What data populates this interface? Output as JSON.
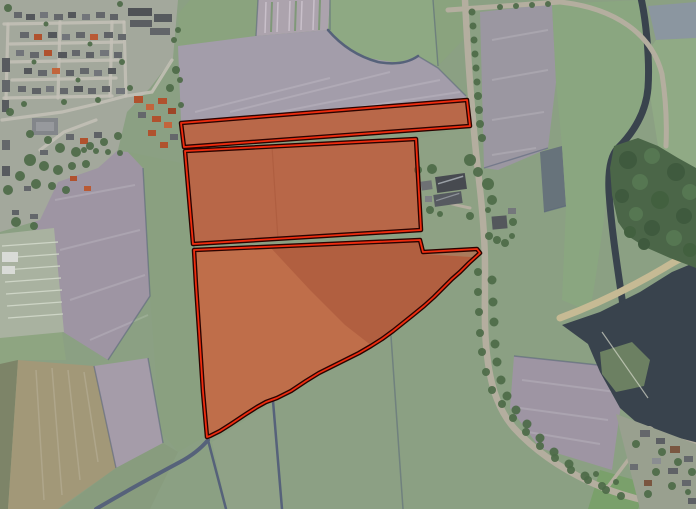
{
  "map": {
    "view_type": "aerial-imagery-with-parcel-overlay",
    "overlay": {
      "fill_color": "#e03414",
      "fill_opacity": "0.36",
      "casing_color": "#2a0300",
      "casing_width": "4.5",
      "stroke_color": "#ef2c0e",
      "stroke_width": "1.8",
      "parcels": [
        {
          "id": "parcel-north-strip",
          "points": "181,123 467,100 470,126 184,147"
        },
        {
          "id": "parcel-middle",
          "points": "185,151 416,139 421,230 193,244"
        },
        {
          "id": "parcel-south",
          "points": "194,250 420,240 423,252 477,249 480,253 469,263 460,272 452,279 444,287 434,297 424,306 413,315 403,323 393,331 382,339 371,346 359,353 345,360 331,367 319,373 306,381 291,391 277,398 266,402 257,407 246,414 231,424 220,431 210,436 207,437 203,392 199,330 196,285"
        }
      ]
    },
    "palette": {
      "field_green": "#8ba083",
      "plowed_pale": "#a39daa",
      "plowed_purple": "#9e95a3",
      "soil_tan": "#a68a67",
      "woodland_green": "#4b6648",
      "tree_green": "#4d6a48",
      "water_dark": "#39434d",
      "marsh_green": "#6c8062",
      "road_gray": "#b4ae9f",
      "shore_sand": "#c6ba94",
      "village_gray": "#a3a89c",
      "ditch_blue": "#56627a",
      "roof_gray": "#64676b",
      "roof_red": "#b0522e",
      "greenhouse_white": "#d9dbd7"
    }
  }
}
